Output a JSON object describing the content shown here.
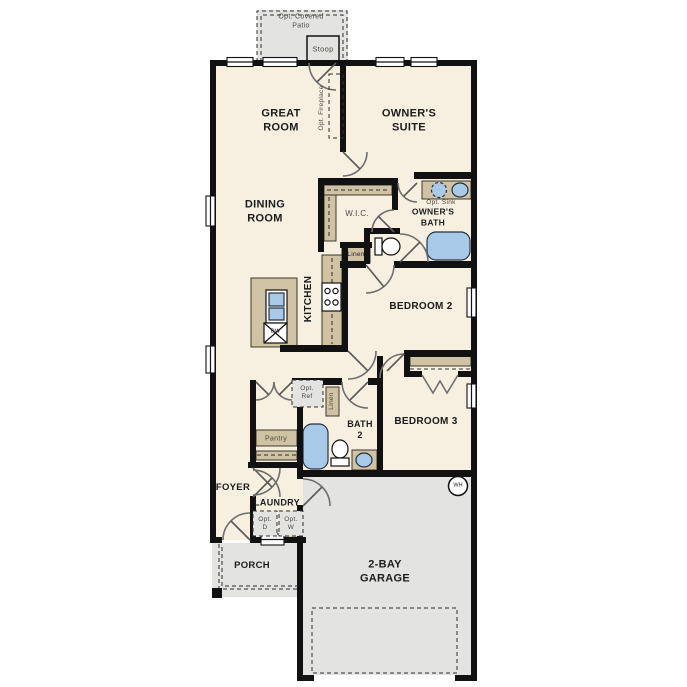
{
  "plan": {
    "type": "single-story floor plan",
    "labels": {
      "opt_covered_patio": "Opt. Covered\nPatio",
      "stoop": "Stoop",
      "great_room": "GREAT\nROOM",
      "owners_suite": "OWNER'S\nSUITE",
      "opt_fireplace": "Opt. Fireplace",
      "dining_room": "DINING\nROOM",
      "wic": "W.I.C.",
      "opt_sink": "Opt. Sink",
      "owners_bath": "OWNER'S\nBATH",
      "linen_hall": "Linen",
      "kitchen": "KITCHEN",
      "dishwasher": "DW",
      "bedroom_2": "BEDROOM 2",
      "opt_ref": "Opt.\nRef",
      "linen_2": "Linen",
      "bath_2": "BATH\n2",
      "bedroom_3": "BEDROOM 3",
      "pantry": "Pantry",
      "foyer": "FOYER",
      "laundry": "LAUNDRY",
      "opt_dryer": "Opt.\nD",
      "opt_washer": "Opt.\nW",
      "porch": "PORCH",
      "garage": "2-BAY\nGARAGE",
      "water_heater": "WH"
    },
    "colors": {
      "wall": "#111111",
      "room": "#f7f0e1",
      "outdoor": "#e3e3e1",
      "tan": "#cfc3a4",
      "blue": "#a9c9e8",
      "door": "#6e6e6e",
      "text": "#1c1c1c"
    }
  }
}
